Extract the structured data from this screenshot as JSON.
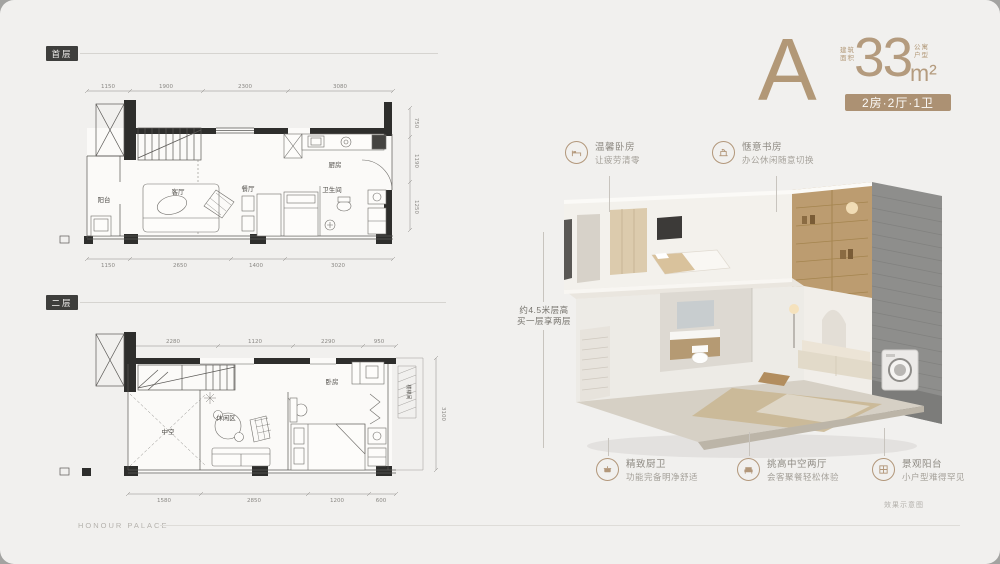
{
  "header": {
    "plan_letter": "A",
    "area_caption_line1": "建筑",
    "area_caption_line2": "面积",
    "area_value": "33",
    "unit_caption_line1": "公寓",
    "unit_caption_line2": "户型",
    "area_unit": "m²",
    "type_badge": "2房·2厅·1卫"
  },
  "floor_plans": {
    "first": {
      "badge": "首层",
      "rooms": {
        "balcony": "阳台",
        "living": "客厅",
        "dining": "餐厅",
        "kitchen": "厨房",
        "bathroom": "卫生间"
      },
      "dims_top": [
        "1150",
        "1900",
        "2300",
        "3080"
      ],
      "dims_bottom": [
        "1150",
        "2650",
        "1400",
        "3020"
      ],
      "dims_right": [
        "750",
        "1190",
        "1250"
      ]
    },
    "second": {
      "badge": "二层",
      "rooms": {
        "void": "中空",
        "leisure": "休闲区",
        "bedroom": "卧房",
        "stairwell": "楼梯间"
      },
      "dims_top": [
        "2280",
        "1120",
        "2290",
        "950"
      ],
      "dims_bottom": [
        "1580",
        "2850",
        "1200",
        "600"
      ],
      "dims_right": [
        "3100"
      ]
    }
  },
  "annotations": {
    "height_note": {
      "line1": "约4.5米层高",
      "line2": "买一层享两层"
    },
    "top": [
      {
        "icon": "bed-icon",
        "title": "温馨卧房",
        "desc": "让疲劳清零"
      },
      {
        "icon": "desk-icon",
        "title": "惬意书房",
        "desc": "办公休闲随意切换"
      }
    ],
    "bottom": [
      {
        "icon": "kitchen-icon",
        "title": "精致厨卫",
        "desc": "功能完备明净舒适"
      },
      {
        "icon": "sofa-icon",
        "title": "挑高中空两厅",
        "desc": "会客聚餐轻松体验"
      },
      {
        "icon": "window-icon",
        "title": "景观阳台",
        "desc": "小户型难得罕见"
      }
    ]
  },
  "footer": {
    "watermark": "HONOUR PALACE",
    "caption": "效果示意图"
  },
  "colors": {
    "accent": "#b2977a",
    "badge_dark": "#3e3e3c",
    "background": "#f1f0ee"
  }
}
